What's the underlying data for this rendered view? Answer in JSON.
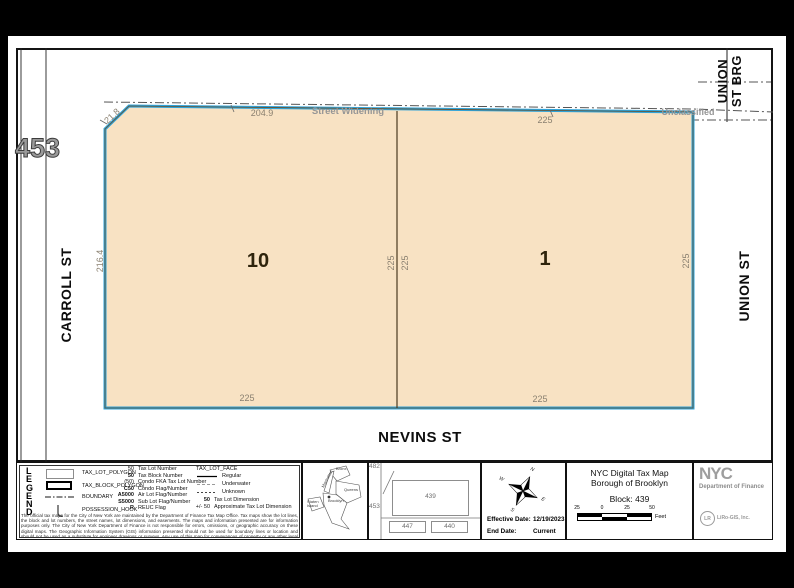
{
  "map": {
    "neighbor_block": "453",
    "street_west": "CARROLL ST",
    "street_south": "NEVINS ST",
    "street_east": "UNION ST",
    "street_bridge_line1": "UNION",
    "street_bridge_line2": "ST BRG",
    "street_widening": "Street Widening",
    "unclassified": "Unclassified",
    "lot10": {
      "number": "10",
      "dim_top_corner": "21.8",
      "dim_top": "204.9",
      "dim_left": "216.4",
      "dim_divider_left": "225",
      "dim_bottom": "225"
    },
    "lot1": {
      "number": "1",
      "dim_top": "225",
      "dim_divider_right": "225",
      "dim_right": "225",
      "dim_bottom": "225"
    },
    "colors": {
      "lot_fill": "#f8e2c3",
      "block_outline": "#2fa3d9",
      "dim_text": "#8a8070",
      "muted_text": "#969696"
    }
  },
  "legend": {
    "title_letters": [
      "L",
      "E",
      "G",
      "E",
      "N",
      "D"
    ],
    "polygon_items": [
      {
        "label": "TAX_LOT_POLYGON"
      },
      {
        "label": "TAX_BLOCK_POLYGON"
      },
      {
        "label": "BOUNDARY"
      },
      {
        "label": "POSSESSION_HOOK"
      }
    ],
    "code_items": [
      {
        "code": "50",
        "label": "Tax Lot Number"
      },
      {
        "code": "50",
        "label": "Tax Block Number"
      },
      {
        "code": "(50)",
        "label": "Condo FKA Tax Lot Number"
      },
      {
        "code": "C50",
        "label": "Condo Flag/Number"
      },
      {
        "code": "A5000",
        "label": "Air Lot Flag/Number"
      },
      {
        "code": "S5000",
        "label": "Sub Lot Flag/Number"
      },
      {
        "code": "R",
        "label": "REUC Flag"
      }
    ],
    "face_title": "TAX_LOT_FACE",
    "face_line_items": [
      {
        "label": "Regular"
      },
      {
        "label": "Underwater"
      },
      {
        "label": "Unknown"
      }
    ],
    "face_code_items": [
      {
        "code": "50",
        "label": "Tax Lot Dimension"
      },
      {
        "code": "+/- 50",
        "label": "Approximate Tax Lot Dimension"
      }
    ],
    "disclaimer": "The official tax maps for the City of New York are maintained by the Department of Finance Tax Map Office. Tax maps show the lot lines, the block and lot numbers, the street names, lot dimensions, and easements. The maps and information presented are for information purposes only. The City of New York Department of Finance is not responsible for errors, omissions, or geographic accuracy on these digital maps. The Geographic Information System (GIS) information presented should not be used for boundary lines or location and should not be used as a substitute for engineer drawings or surveys. Any use of this map for conveyances of property or any other legal proceeding is at the sole risk of the parties."
  },
  "inset": {
    "bronx": "Bronx",
    "manhattan": "Manhattan",
    "queens": "Queens",
    "brooklyn": "Brooklyn",
    "staten_island": "Staten Island"
  },
  "locator": {
    "top_left": "482",
    "left": "453",
    "center": "439",
    "bottom_left": "447",
    "bottom_right": "440"
  },
  "compass": {
    "n": "N",
    "e": "E",
    "s": "S",
    "w": "W"
  },
  "dates": {
    "effective_label": "Effective Date:",
    "effective_value": "12/19/2023",
    "end_label": "End Date:",
    "end_value": "Current"
  },
  "title_block": {
    "line1": "NYC Digital Tax Map",
    "line2": "Borough of Brooklyn",
    "line3": "Block: 439",
    "scale_labels": [
      "25",
      "0",
      "25",
      "50"
    ],
    "scale_unit": "Feet"
  },
  "branding": {
    "logo": "NYC",
    "agency": "Department of Finance",
    "vendor": "LiRo-GIS, Inc.",
    "vendor_mark": "LR"
  }
}
